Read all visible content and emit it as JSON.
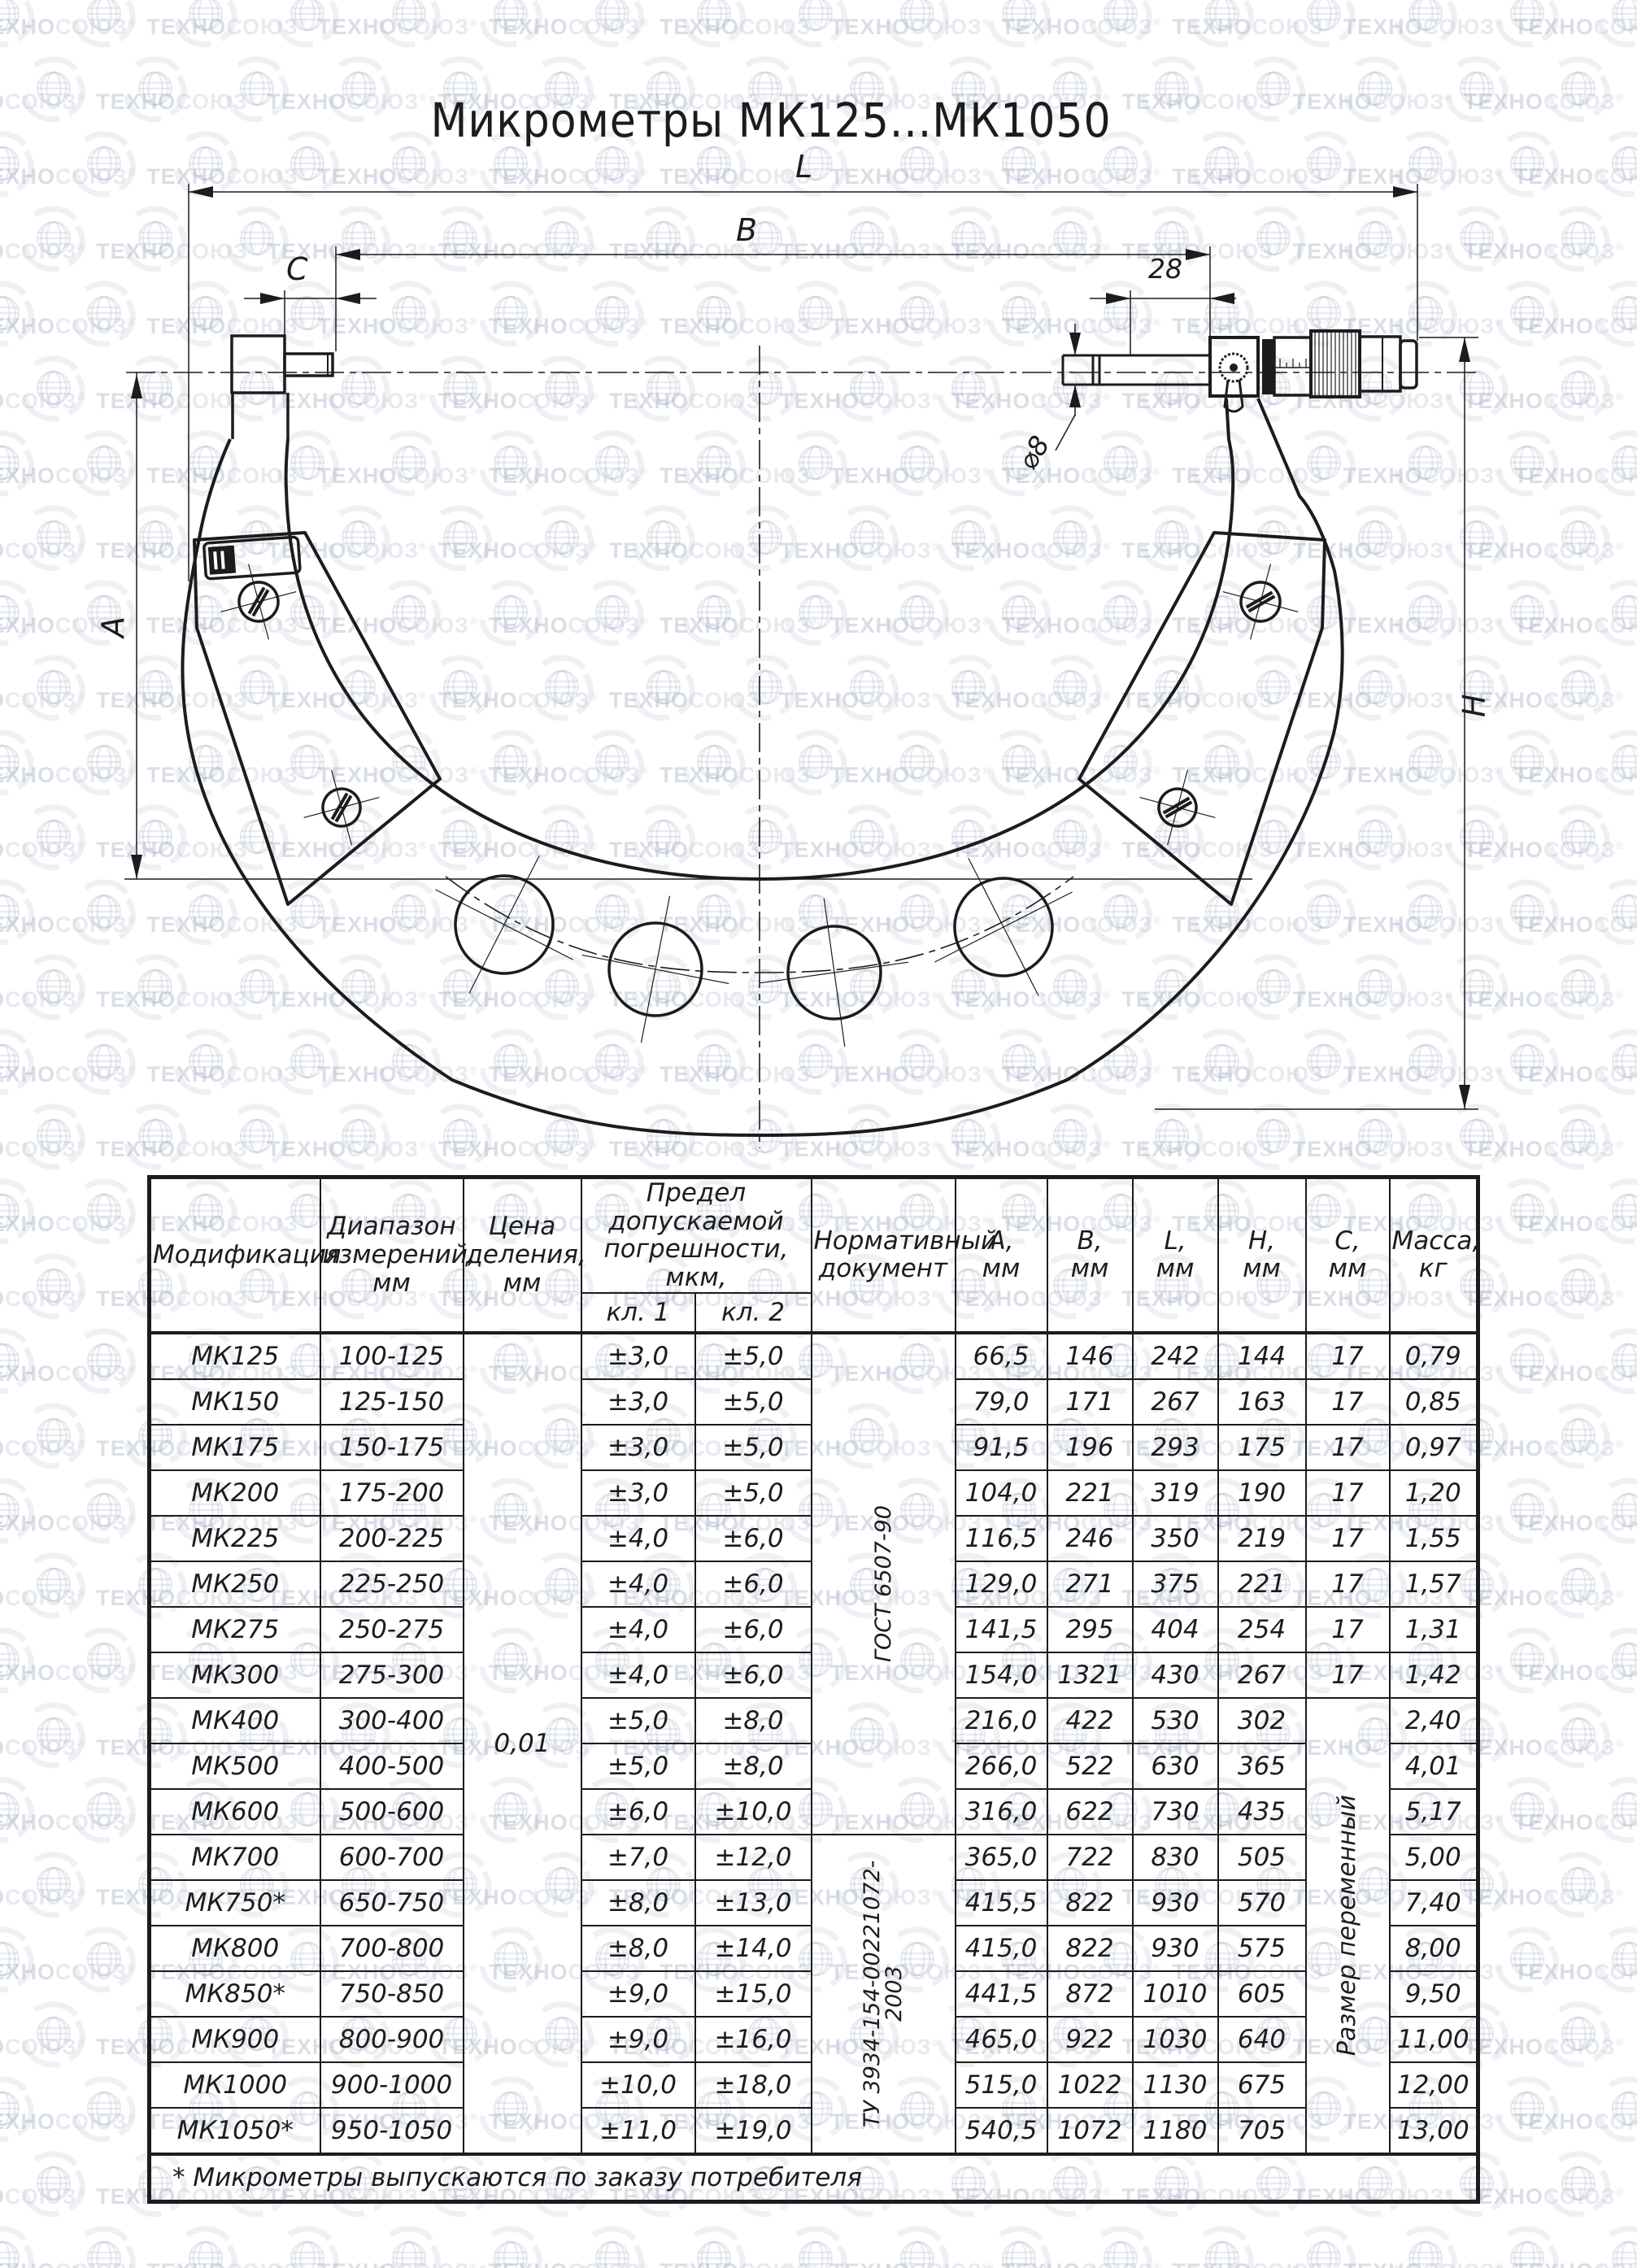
{
  "title": "Микрометры МК125...МК1050",
  "watermark": {
    "brand_bold": "ТЕХНО",
    "brand_light": "СОЮЗ",
    "registered": "®"
  },
  "drawing": {
    "labels": {
      "total_length": "L",
      "base_length": "B",
      "anvil_length": "C",
      "spindle_extension": "28",
      "spindle_diameter": "⌀8",
      "gauge_depth": "A",
      "frame_height": "H"
    }
  },
  "table": {
    "headers": {
      "modification": "Модификация",
      "range": "Диапазон\nизмерений,\nмм",
      "division": "Цена\nделения,\nмм",
      "error_limit": "Предел допускаемой\nпогрешности, мкм,",
      "class1": "кл. 1",
      "class2": "кл. 2",
      "document": "Нормативный\nдокумент",
      "a": "А,\nмм",
      "b": "В,\nмм",
      "l": "L,\nмм",
      "h": "Н,\nмм",
      "c": "С,\nмм",
      "mass": "Масса,\nкг"
    },
    "merged": {
      "division_value": "0,01",
      "doc_gost": "ГОСТ 6507-90",
      "doc_tu": "ТУ 3934-154-00221072-2003",
      "c_variable": "Размер переменный"
    },
    "rows": [
      {
        "mod": "МК125",
        "range": "100-125",
        "kl1": "±3,0",
        "kl2": "±5,0",
        "a": "66,5",
        "b": "146",
        "l": "242",
        "h": "144",
        "c": "17",
        "mass": "0,79"
      },
      {
        "mod": "МК150",
        "range": "125-150",
        "kl1": "±3,0",
        "kl2": "±5,0",
        "a": "79,0",
        "b": "171",
        "l": "267",
        "h": "163",
        "c": "17",
        "mass": "0,85"
      },
      {
        "mod": "МК175",
        "range": "150-175",
        "kl1": "±3,0",
        "kl2": "±5,0",
        "a": "91,5",
        "b": "196",
        "l": "293",
        "h": "175",
        "c": "17",
        "mass": "0,97"
      },
      {
        "mod": "МК200",
        "range": "175-200",
        "kl1": "±3,0",
        "kl2": "±5,0",
        "a": "104,0",
        "b": "221",
        "l": "319",
        "h": "190",
        "c": "17",
        "mass": "1,20"
      },
      {
        "mod": "МК225",
        "range": "200-225",
        "kl1": "±4,0",
        "kl2": "±6,0",
        "a": "116,5",
        "b": "246",
        "l": "350",
        "h": "219",
        "c": "17",
        "mass": "1,55"
      },
      {
        "mod": "МК250",
        "range": "225-250",
        "kl1": "±4,0",
        "kl2": "±6,0",
        "a": "129,0",
        "b": "271",
        "l": "375",
        "h": "221",
        "c": "17",
        "mass": "1,57"
      },
      {
        "mod": "МК275",
        "range": "250-275",
        "kl1": "±4,0",
        "kl2": "±6,0",
        "a": "141,5",
        "b": "295",
        "l": "404",
        "h": "254",
        "c": "17",
        "mass": "1,31"
      },
      {
        "mod": "МК300",
        "range": "275-300",
        "kl1": "±4,0",
        "kl2": "±6,0",
        "a": "154,0",
        "b": "1321",
        "l": "430",
        "h": "267",
        "c": "17",
        "mass": "1,42"
      },
      {
        "mod": "МК400",
        "range": "300-400",
        "kl1": "±5,0",
        "kl2": "±8,0",
        "a": "216,0",
        "b": "422",
        "l": "530",
        "h": "302",
        "mass": "2,40"
      },
      {
        "mod": "МК500",
        "range": "400-500",
        "kl1": "±5,0",
        "kl2": "±8,0",
        "a": "266,0",
        "b": "522",
        "l": "630",
        "h": "365",
        "mass": "4,01"
      },
      {
        "mod": "МК600",
        "range": "500-600",
        "kl1": "±6,0",
        "kl2": "±10,0",
        "a": "316,0",
        "b": "622",
        "l": "730",
        "h": "435",
        "mass": "5,17"
      },
      {
        "mod": "МК700",
        "range": "600-700",
        "kl1": "±7,0",
        "kl2": "±12,0",
        "a": "365,0",
        "b": "722",
        "l": "830",
        "h": "505",
        "mass": "5,00"
      },
      {
        "mod": "МК750*",
        "range": "650-750",
        "kl1": "±8,0",
        "kl2": "±13,0",
        "a": "415,5",
        "b": "822",
        "l": "930",
        "h": "570",
        "mass": "7,40"
      },
      {
        "mod": "МК800",
        "range": "700-800",
        "kl1": "±8,0",
        "kl2": "±14,0",
        "a": "415,0",
        "b": "822",
        "l": "930",
        "h": "575",
        "mass": "8,00"
      },
      {
        "mod": "МК850*",
        "range": "750-850",
        "kl1": "±9,0",
        "kl2": "±15,0",
        "a": "441,5",
        "b": "872",
        "l": "1010",
        "h": "605",
        "mass": "9,50"
      },
      {
        "mod": "МК900",
        "range": "800-900",
        "kl1": "±9,0",
        "kl2": "±16,0",
        "a": "465,0",
        "b": "922",
        "l": "1030",
        "h": "640",
        "mass": "11,00"
      },
      {
        "mod": "МК1000",
        "range": "900-1000",
        "kl1": "±10,0",
        "kl2": "±18,0",
        "a": "515,0",
        "b": "1022",
        "l": "1130",
        "h": "675",
        "mass": "12,00"
      },
      {
        "mod": "МК1050*",
        "range": "950-1050",
        "kl1": "±11,0",
        "kl2": "±19,0",
        "a": "540,5",
        "b": "1072",
        "l": "1180",
        "h": "705",
        "mass": "13,00"
      }
    ],
    "footnote": "* Микрометры выпускаются по заказу потребителя"
  }
}
